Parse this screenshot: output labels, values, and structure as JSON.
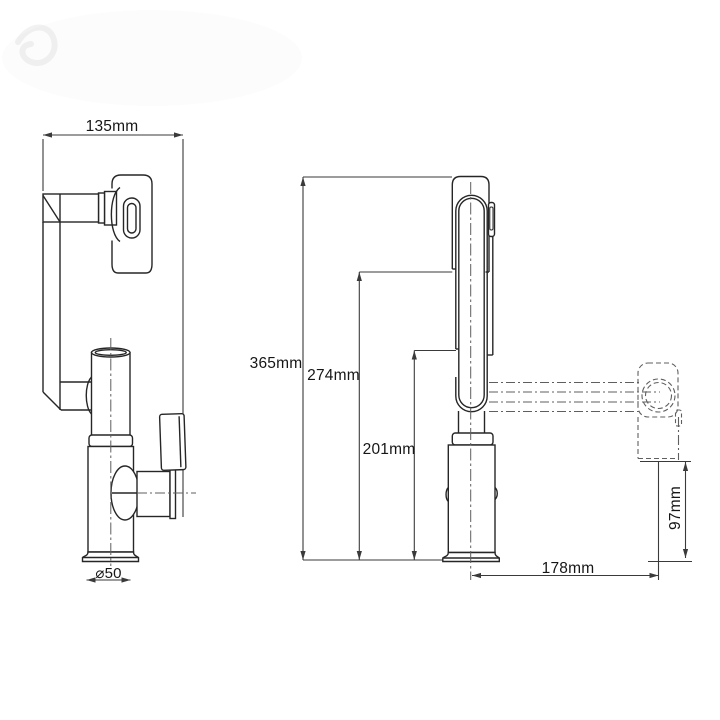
{
  "drawing": {
    "title": "faucet-technical-drawing",
    "side_view": {
      "width": "135mm",
      "base_diameter": "⌀50"
    },
    "front_view": {
      "overall_height": "365mm",
      "spout_shell_height": "274mm",
      "hose_outlet_height": "201mm",
      "spray_reach": "178mm",
      "spray_head_drop": "97mm"
    }
  },
  "colors": {
    "background": "#ffffff",
    "outline": "#262626",
    "dimension": "#3a3a3a",
    "phantom": "#5f5f5f",
    "text": "#161616"
  }
}
